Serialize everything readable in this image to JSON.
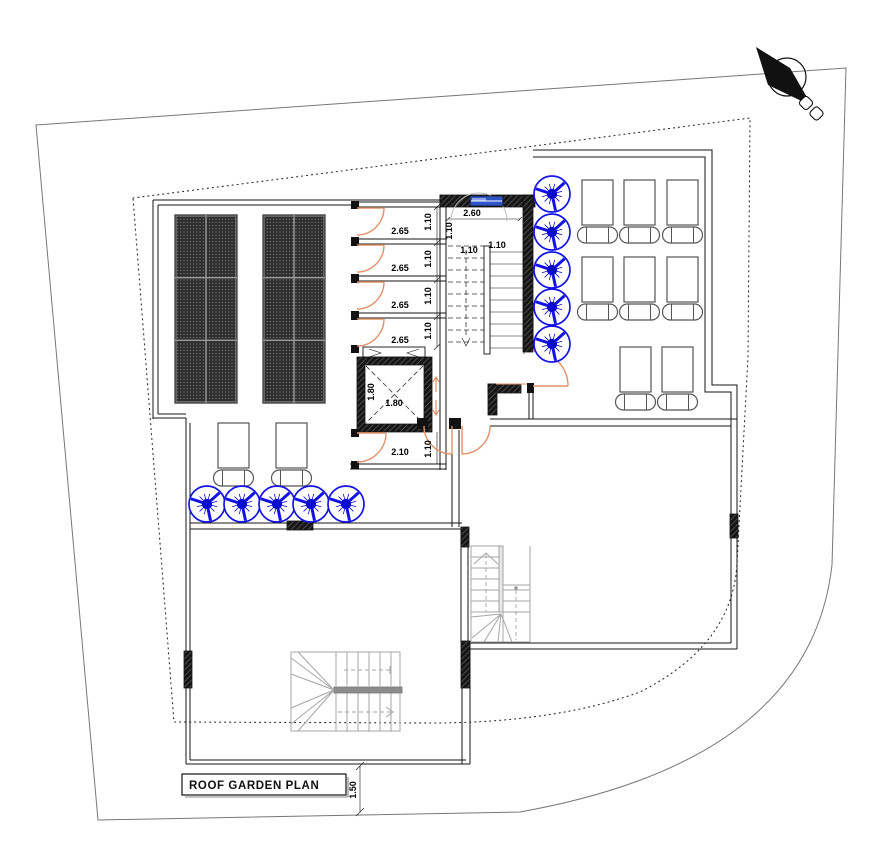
{
  "title_block": {
    "label": "ROOF GARDEN PLAN"
  },
  "colors": {
    "wall": "#141414",
    "door_orange": "#E2916A",
    "plant_blue": "#1414E6",
    "plant_core": "#0b0bd0",
    "window_blue": "#2F54C8",
    "window_light": "#8FA4E8",
    "stair_gray": "#a6a6a6",
    "panel_dark": "#2d2d2d",
    "panel_grid": "#9a9a9a"
  },
  "north_arrow": {
    "icon": "north-arrow",
    "direction": "northwest"
  },
  "window": {
    "type": "stair-window",
    "count": 1
  },
  "dimensions": [
    {
      "text": "2.65",
      "x": 400,
      "y": 234,
      "rot": 0
    },
    {
      "text": "2.65",
      "x": 400,
      "y": 271,
      "rot": 0
    },
    {
      "text": "2.65",
      "x": 400,
      "y": 308,
      "rot": 0
    },
    {
      "text": "2.65",
      "x": 400,
      "y": 343,
      "rot": 0
    },
    {
      "text": "1.10",
      "x": 431,
      "y": 222,
      "rot": -90
    },
    {
      "text": "1.10",
      "x": 431,
      "y": 259,
      "rot": -90
    },
    {
      "text": "1.10",
      "x": 431,
      "y": 296,
      "rot": -90
    },
    {
      "text": "1.10",
      "x": 431,
      "y": 331,
      "rot": -90
    },
    {
      "text": "2.60",
      "x": 472,
      "y": 216,
      "rot": 0
    },
    {
      "text": "1.10",
      "x": 452,
      "y": 231,
      "rot": -90
    },
    {
      "text": "1.10",
      "x": 469,
      "y": 253,
      "rot": 0
    },
    {
      "text": "1.10",
      "x": 497,
      "y": 248,
      "rot": 0
    },
    {
      "text": "1.80",
      "x": 374,
      "y": 392,
      "rot": -90
    },
    {
      "text": "1.80",
      "x": 394,
      "y": 406,
      "rot": 0
    },
    {
      "text": "2.10",
      "x": 400,
      "y": 455,
      "rot": 0
    },
    {
      "text": "1.10",
      "x": 431,
      "y": 449,
      "rot": -90
    },
    {
      "text": "1.50",
      "x": 356,
      "y": 790,
      "rot": -90
    }
  ],
  "symbols": {
    "solar_panels": {
      "groups": [
        {
          "x": 175,
          "y": 215
        },
        {
          "x": 263,
          "y": 215
        }
      ],
      "group_w": 62,
      "group_h": 188,
      "cols": 2,
      "rows": 3
    },
    "plants": {
      "radius": 18,
      "positions": [
        [
          552,
          194
        ],
        [
          552,
          232
        ],
        [
          552,
          270
        ],
        [
          552,
          307
        ],
        [
          552,
          344
        ],
        [
          207,
          504
        ],
        [
          242,
          504
        ],
        [
          277,
          504
        ],
        [
          311,
          504
        ],
        [
          346,
          504
        ]
      ]
    },
    "loungers": {
      "rect_w": 31,
      "rect_h": 45,
      "pill_w": 40,
      "pill_h": 16,
      "positions": [
        [
          582,
          180
        ],
        [
          624,
          180
        ],
        [
          667,
          180
        ],
        [
          582,
          257
        ],
        [
          624,
          257
        ],
        [
          667,
          257
        ],
        [
          620,
          347
        ],
        [
          662,
          347
        ],
        [
          218,
          423
        ],
        [
          276,
          423
        ]
      ]
    }
  }
}
